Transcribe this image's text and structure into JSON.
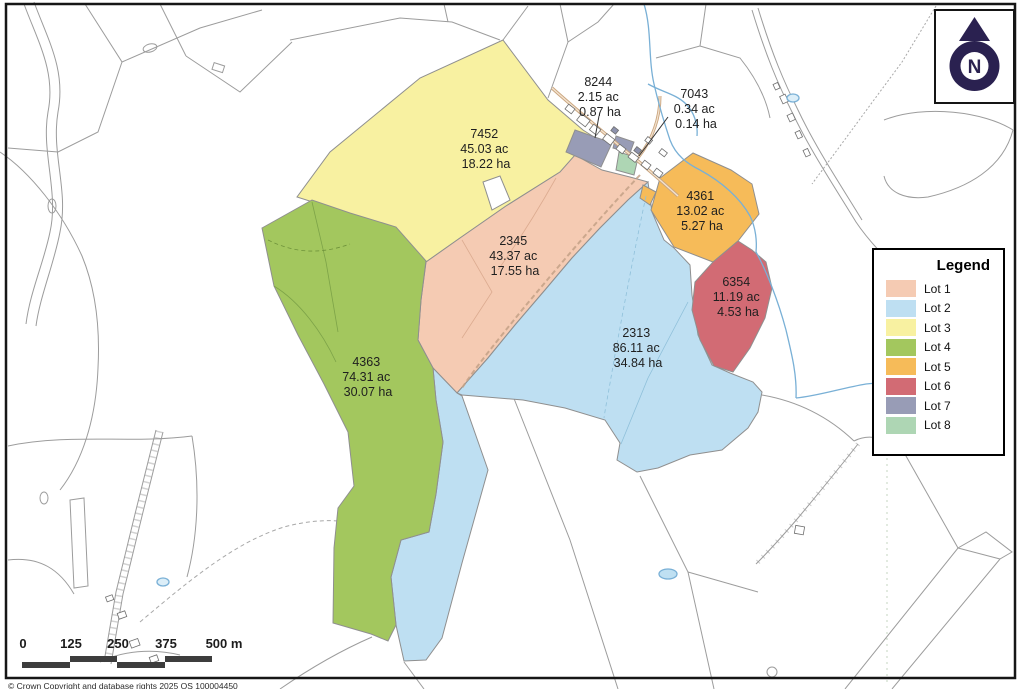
{
  "lots": [
    {
      "name": "Lot 1",
      "color": "#f5cbb3",
      "parcel_id": "2345",
      "acres": "43.37 ac",
      "hectares": "17.55 ha"
    },
    {
      "name": "Lot 2",
      "color": "#bedff2",
      "parcel_id": "2313",
      "acres": "86.11 ac",
      "hectares": "34.84 ha"
    },
    {
      "name": "Lot 3",
      "color": "#f8f1a1",
      "parcel_id": "7452",
      "acres": "45.03 ac",
      "hectares": "18.22 ha"
    },
    {
      "name": "Lot 4",
      "color": "#a3c75e",
      "parcel_id": "4363",
      "acres": "74.31 ac",
      "hectares": "30.07 ha"
    },
    {
      "name": "Lot 5",
      "color": "#f6bb59",
      "parcel_id": "4361",
      "acres": "13.02 ac",
      "hectares": "5.27 ha"
    },
    {
      "name": "Lot 6",
      "color": "#d26b74",
      "parcel_id": "6354",
      "acres": "11.19 ac",
      "hectares": "4.53 ha"
    },
    {
      "name": "Lot 7",
      "color": "#989cb6",
      "parcel_id": "8244",
      "acres": "2.15 ac",
      "hectares": "0.87 ha"
    },
    {
      "name": "Lot 8",
      "color": "#aed6b4",
      "parcel_id": "7043",
      "acres": "0.34 ac",
      "hectares": "0.14 ha"
    }
  ],
  "legend": {
    "title": "Legend"
  },
  "north_arrow": {
    "label": "N",
    "color": "#2a2150"
  },
  "scale_bar": {
    "tick_labels": [
      "0",
      "125",
      "250",
      "375",
      "500 m"
    ]
  },
  "copyright": "© Crown Copyright and database rights 2025 OS 100004450"
}
